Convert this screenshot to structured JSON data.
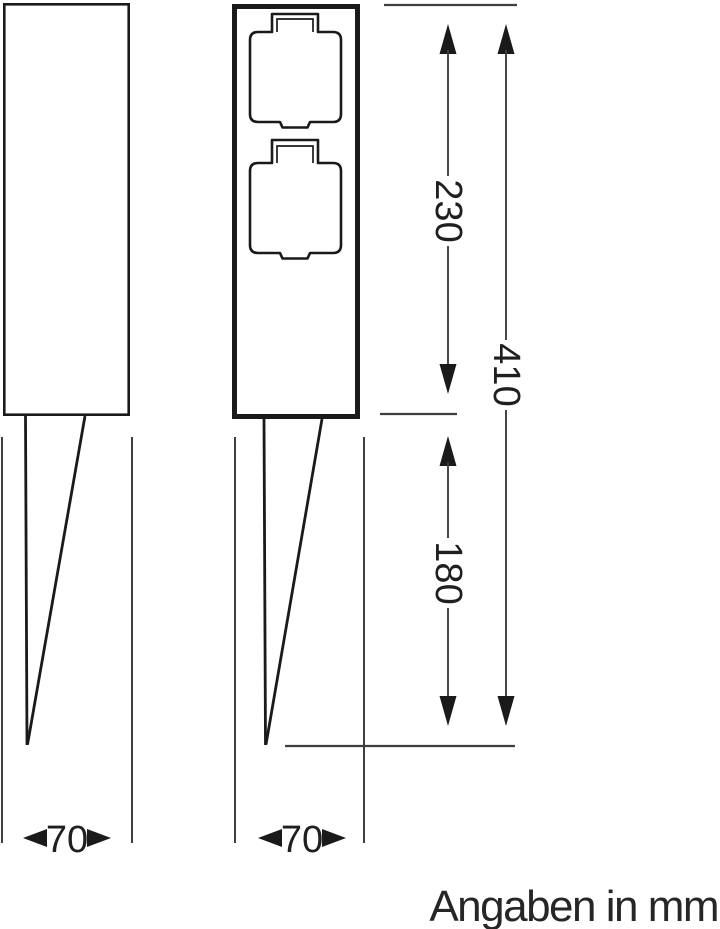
{
  "note": {
    "units": "Angaben in mm"
  },
  "dimensions": {
    "body_height": "230",
    "total_height": "410",
    "spike_length": "180",
    "side_width": "70",
    "front_width": "70"
  },
  "views": {
    "side": {
      "label": "side-view-outline"
    },
    "front": {
      "label": "front-view-outline",
      "socket_count": "2"
    }
  },
  "colors": {
    "line": "#1a1a1a",
    "thin_line": "#3f3f3f",
    "background": "#ffffff"
  }
}
